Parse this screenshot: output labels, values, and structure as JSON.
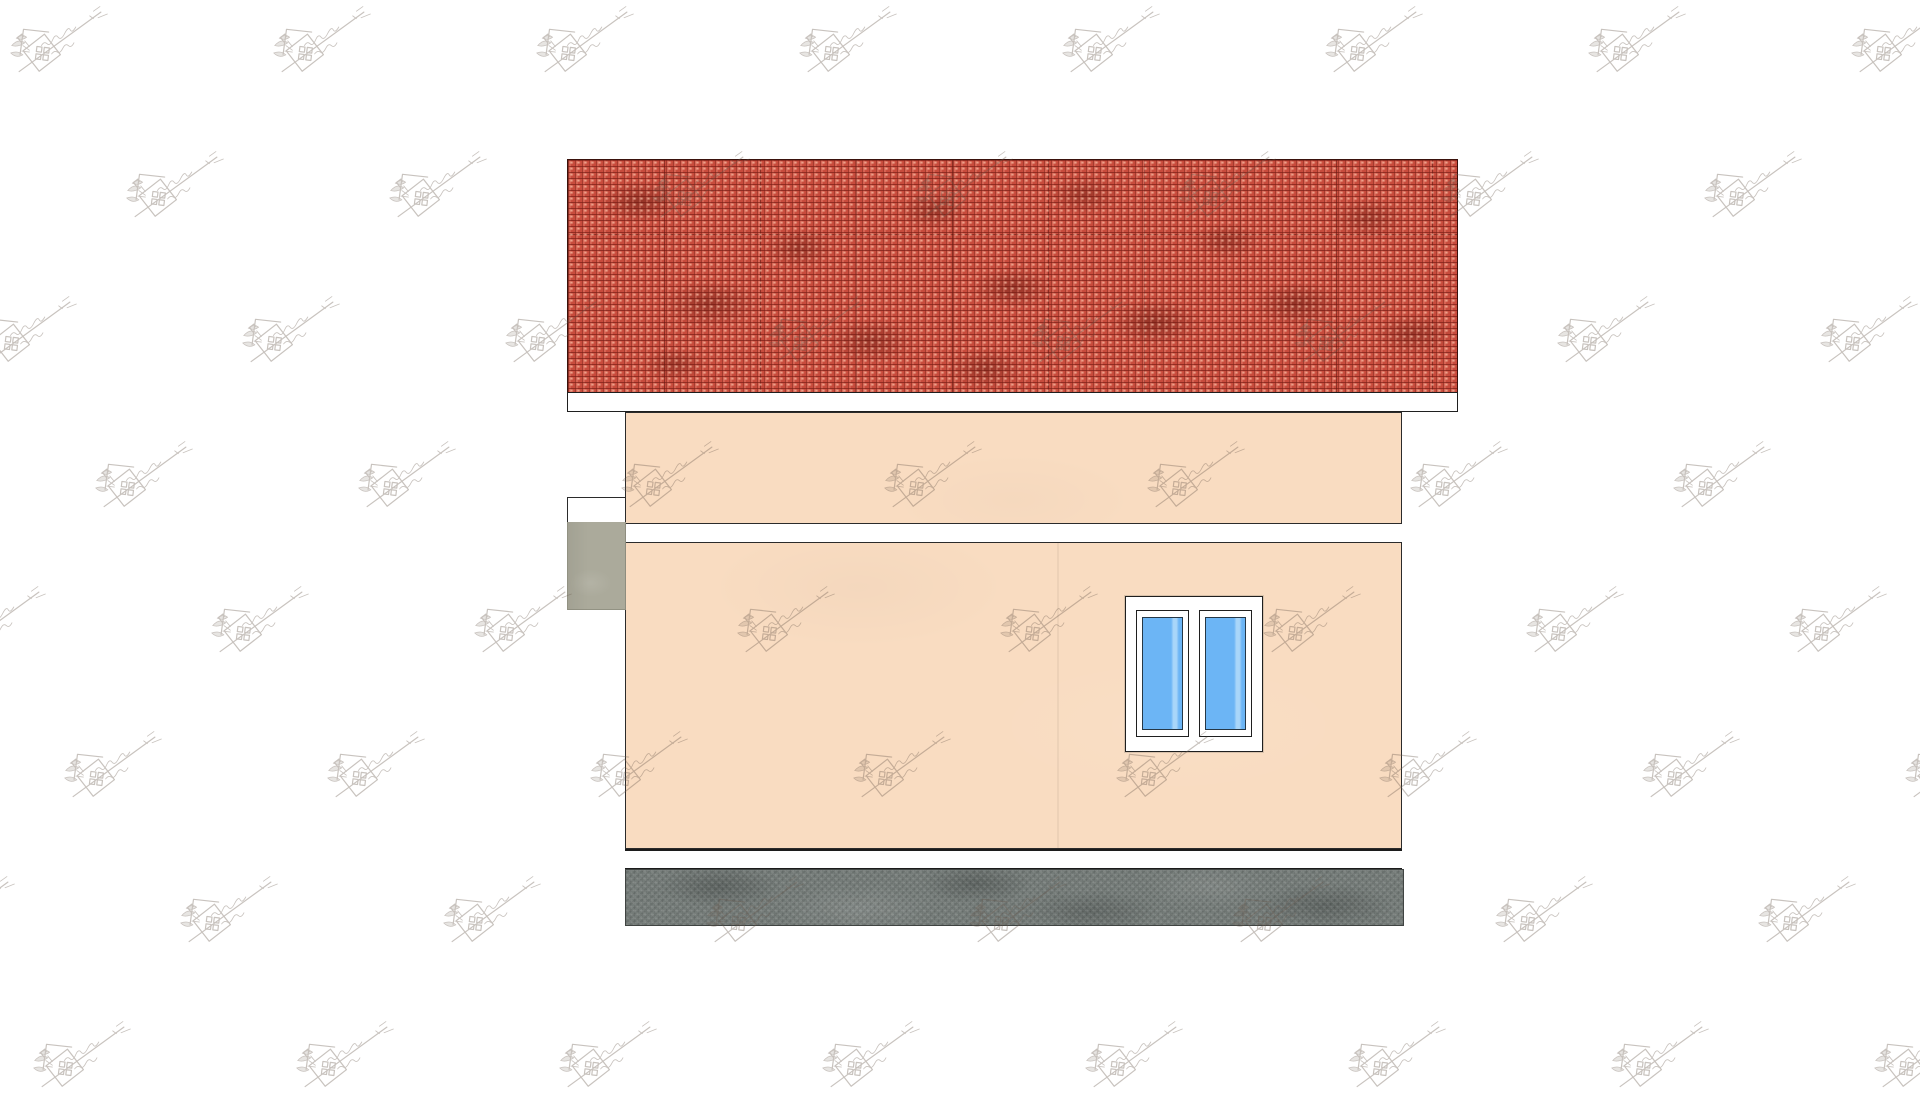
{
  "scene": {
    "type": "architectural-elevation-render",
    "subject": "single-storey house side elevation with tiled roof, plaster wall, double window, plinth and foundation",
    "visible_text": []
  },
  "palette": {
    "bg": "#ffffff",
    "outline": "#1f1f1f",
    "roof_base": "#c84b3c",
    "roof_light": "#f29a87",
    "roof_dark": "#7c271f",
    "fascia_white": "#ffffff",
    "wall_peach": "#f9dcc1",
    "band_white": "#ffffff",
    "glass_blue": "#6cb5f5",
    "glass_highlight": "#a9d6f9",
    "frame_white": "#ffffff",
    "pier_gray": "#abaa9b",
    "foundation_gray": "#757c79",
    "watermark_ink": "#6a5a4e"
  },
  "watermark": {
    "icon": "house-bird-logo-watermark",
    "opacity": 0.36,
    "grid": {
      "x0": 8,
      "y0": 2,
      "col_spacing": 263,
      "row_spacing": 145,
      "row_shift": 116,
      "rows": 8,
      "cols": 9
    }
  }
}
